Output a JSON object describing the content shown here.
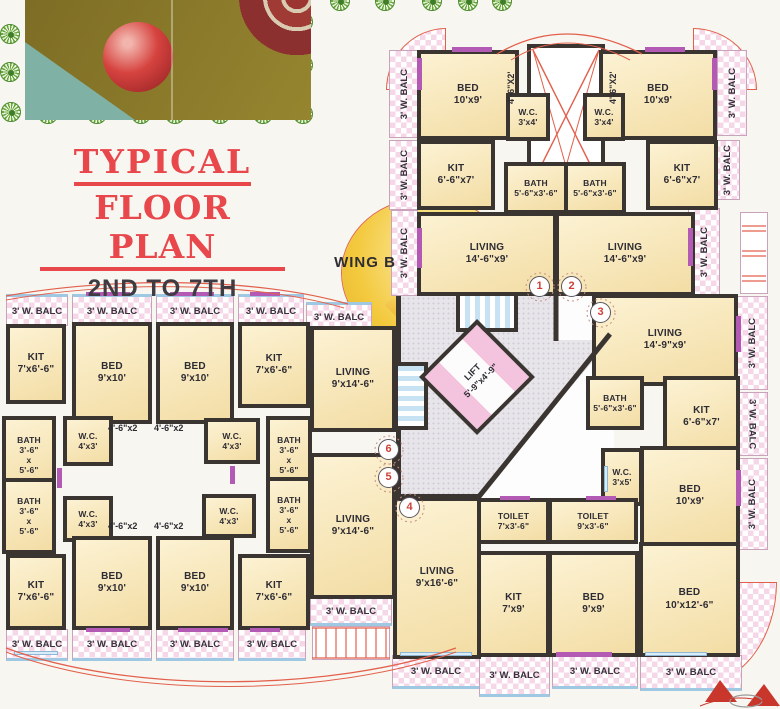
{
  "title": {
    "line1": "TYPICAL",
    "line2": "FLOOR PLAN",
    "line3": "2ND TO 7TH"
  },
  "wing_label": "WING B",
  "balcony_label": "3' W. BALC",
  "lift_label": "LIFT\n5'-9\"x4'-9\"",
  "dim_labels": {
    "w462_caps": "4'-6\"X2'",
    "w462": "4'-6\"x2"
  },
  "flat_numbers": [
    "1",
    "2",
    "3",
    "4",
    "5",
    "6"
  ],
  "rooms": {
    "bed_10x9": "BED\n10'x9'",
    "bed_9x10": "BED\n9'x10'",
    "bed_9x9": "BED\n9'x9'",
    "bed_10x12_6": "BED\n10'x12'-6\"",
    "wc_3x4": "W.C.\n3'x4'",
    "wc_4x3": "W.C.\n4'x3'",
    "wc_3x5": "W.C.\n3'x5'",
    "kit_6_6x7": "KIT\n6'-6\"x7'",
    "kit_7x6_6": "KIT\n7'x6'-6\"",
    "kit_7x9": "KIT\n7'x9'",
    "bath_5_6x3_6": "BATH\n5'-6\"x3'-6\"",
    "bath_3_6x5_6": "BATH\n3'-6\"\nx\n5'-6\"",
    "living_14_6x9": "LIVING\n14'-6\"x9'",
    "living_14_9x9": "LIVING\n14'-9\"x9'",
    "living_9x14_6": "LIVING\n9'x14'-6\"",
    "living_9x16_6": "LIVING\n9'x16'-6\"",
    "toilet_7x3_6": "TOILET\n7'x3'-6\"",
    "toilet_9x3_6": "TOILET\n9'x3'-6\""
  },
  "colors": {
    "accent_red": "#e8474b",
    "wall": "#3a3531",
    "room_fill": "#f7e8c0",
    "balcony_pink": "#f6d7e8",
    "lift_pink": "#f4c3de",
    "stairs_blue": "#c7e2f3",
    "wing_yellow": "#f3c93e",
    "lobby_gray": "#e7e5ea",
    "window_purple": "#b25ab4"
  }
}
